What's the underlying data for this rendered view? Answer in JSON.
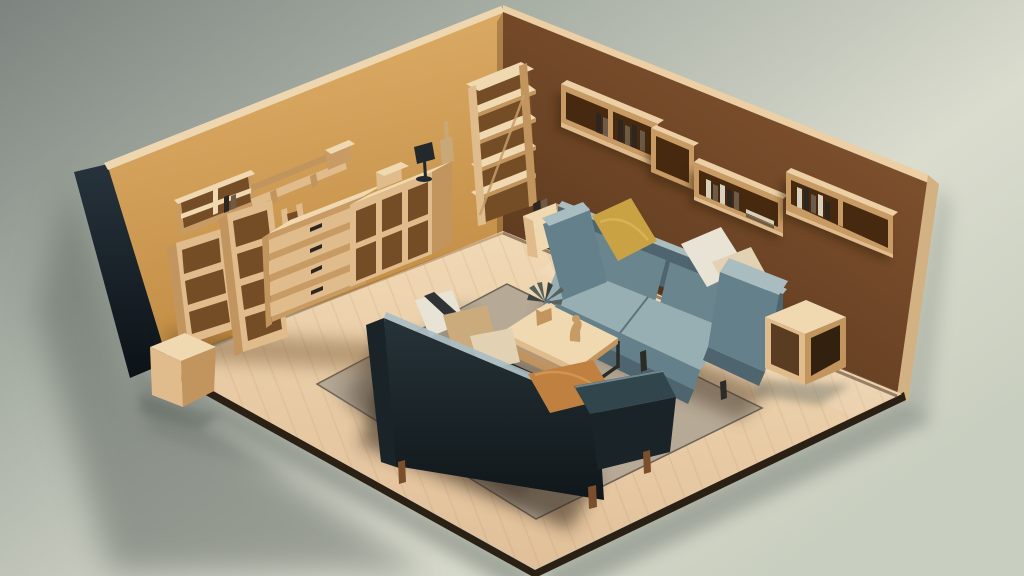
{
  "scene": {
    "type": "3d-isometric-render",
    "subject": "miniature living room diorama with wooden furniture",
    "view": "isometric cutaway, two walls visible",
    "background": "plain gray-green studio backdrop"
  },
  "palette": {
    "bg_top_left": "#7d847f",
    "bg_mid": "#a9b0a6",
    "bg_light": "#dadcce",
    "bg_bottom": "#c9cfc0",
    "shadow_color": "#5d655f",
    "wall_left_top": "#e0b16b",
    "wall_left_bottom": "#c28c44",
    "wall_edge_dark_top": "#27333c",
    "wall_edge_dark_bottom": "#0c1217",
    "wall_top_strip": "#eed7b0",
    "wall_right_top": "#8a5933",
    "wall_right_bottom": "#5a371d",
    "wall_right_side": "#d2b183",
    "wall_right_strip": "#eccfa5",
    "floor_top": "#f2dab6",
    "floor_bottom": "#e0bf98",
    "floor_edge": "#2a2014",
    "rug_base": "#b6a996",
    "rug_shadow": "#8c8172",
    "rug_dark": "#5e5142",
    "wood_top": "#f0d9b0",
    "wood_front": "#e0bb8b",
    "wood_side": "#c2955f",
    "wood_frame": "#c89a64",
    "wood_deep": "#744c26",
    "wood_deeper": "#46290f",
    "book_dark": "#2e2620",
    "book_mid": "#6b5b48",
    "book_light": "#d9d0bc",
    "leg_wood": "#7b4f2c",
    "metal_dark": "#2b2b28",
    "sofa_blue_back": "#6a858e",
    "sofa_blue_cushion": "#97aeb3",
    "sofa_blue_light": "#a9bcc0",
    "sofa_blue_arm": "#64808a",
    "sofa_blue_dark": "#4e656f",
    "pillow_mustard": "#c9a243",
    "pillow_white": "#e9e3d5",
    "pillow_cream": "#e2d2b3",
    "pillow_tan": "#cbaa7c",
    "pillow_caramel": "#bf8040",
    "sofa_dark_top": "#263338",
    "sofa_dark_bottom": "#10171a",
    "sofa_dark_arm": "#31454c",
    "sofa_dark_deep": "#1a2428",
    "sofa_dark_highlight": "#a9bcc4",
    "plant_leaf": "#57615d",
    "plant_leaf_dark": "#3a443f",
    "figurine": "#c59c66",
    "lamp_dark": "#23282c",
    "bottle": "#c9a877"
  },
  "objects": [
    {
      "id": "left-wall",
      "name": "ochre accent wall with dark outer edge"
    },
    {
      "id": "right-wall",
      "name": "brown accent wall with wood top edge"
    },
    {
      "id": "floor",
      "name": "light wood plank floor"
    },
    {
      "id": "rug",
      "name": "beige area rug"
    },
    {
      "id": "blue-sofa",
      "name": "slate-blue three-seat sofa against right wall"
    },
    {
      "id": "dark-sofa",
      "name": "dark navy sofa seen from behind"
    },
    {
      "id": "coffee-table",
      "name": "wood coffee table with dark metal frame"
    },
    {
      "id": "plant",
      "name": "small potted plant on coffee table"
    },
    {
      "id": "figurine",
      "name": "small wooden figurine on coffee table"
    },
    {
      "id": "wall-shelves-right",
      "name": "floating box shelves with books on right wall"
    },
    {
      "id": "wall-shelves-left",
      "name": "angled wall shelves on left wall"
    },
    {
      "id": "dresser",
      "name": "four-drawer wooden dresser"
    },
    {
      "id": "leaning-bookcases",
      "name": "leaning wooden bookcases"
    },
    {
      "id": "cube-unit",
      "name": "cubby storage unit"
    },
    {
      "id": "ladder-shelf",
      "name": "tall corner ladder shelf"
    },
    {
      "id": "side-table-corner",
      "name": "small open side table with books"
    },
    {
      "id": "cube-side-table",
      "name": "open cube side table"
    },
    {
      "id": "cardboard-box",
      "name": "cardboard box at floor corner"
    },
    {
      "id": "table-lamp",
      "name": "small dark table lamp on cubby unit"
    },
    {
      "id": "bottle-vase",
      "name": "slender bottle vase"
    }
  ]
}
